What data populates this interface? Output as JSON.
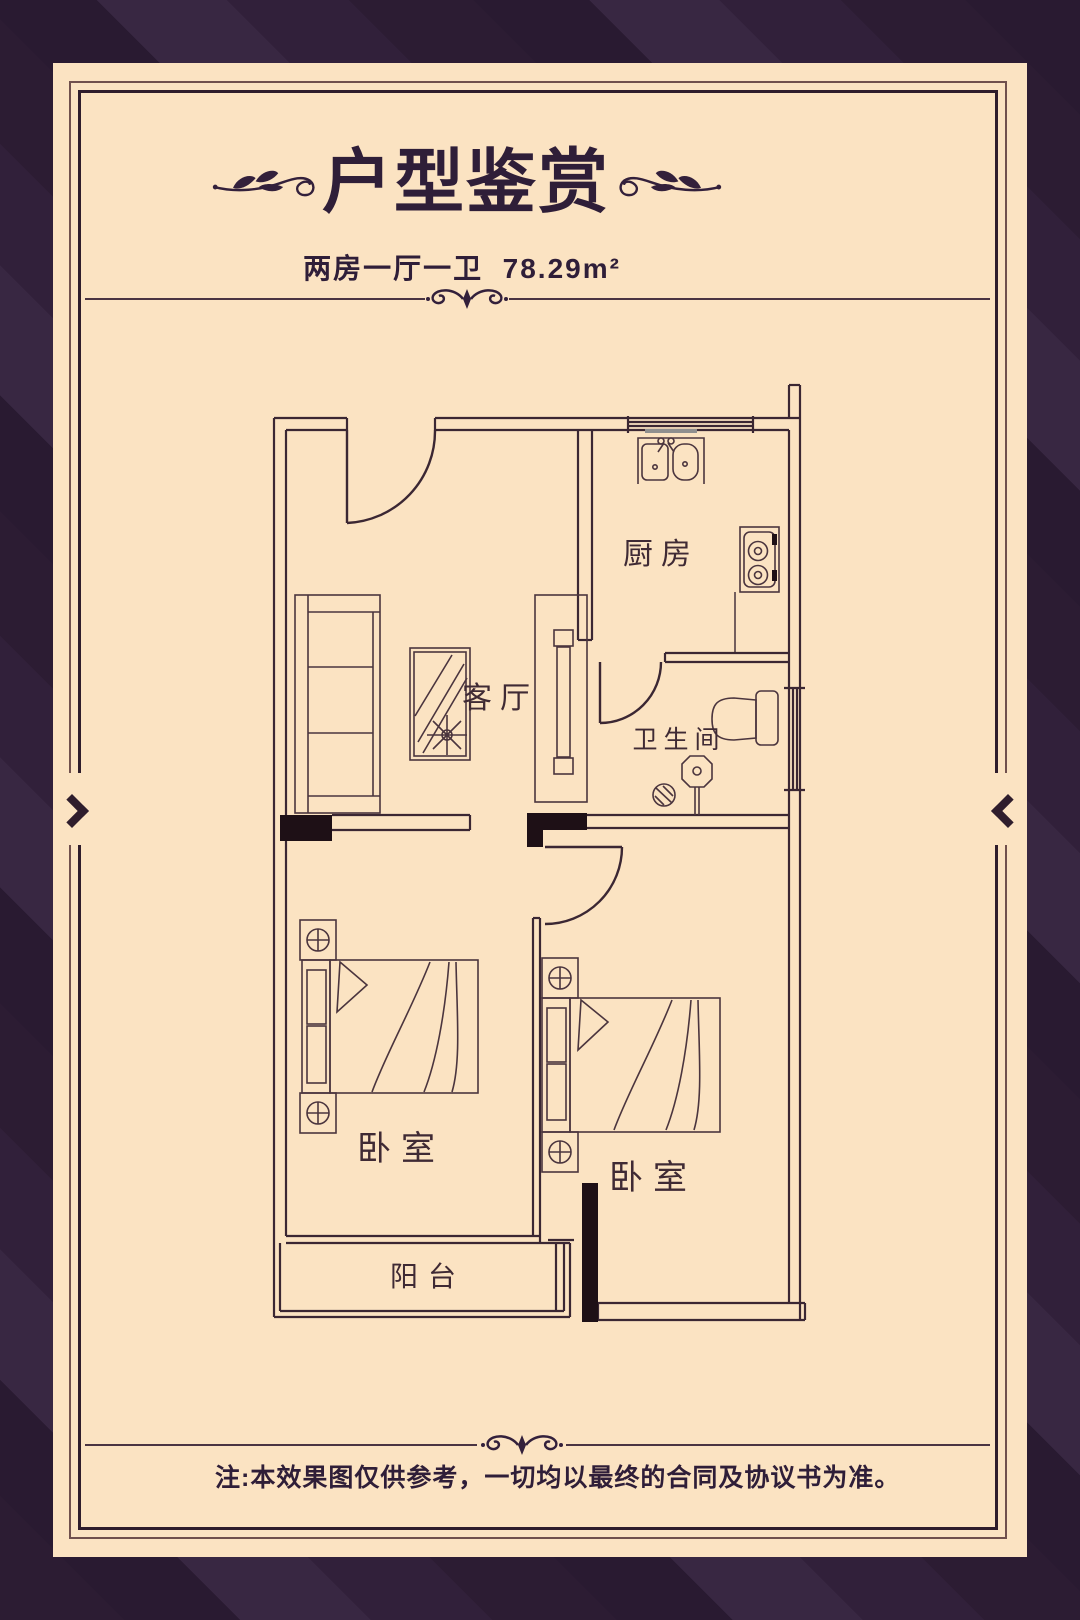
{
  "header": {
    "title": "户型鉴赏",
    "layout_text": "两房一厅一卫",
    "area_text": "78.29m²"
  },
  "floor_plan": {
    "rooms": [
      {
        "name": "kitchen",
        "label": "厨房"
      },
      {
        "name": "living-room",
        "label": "客厅"
      },
      {
        "name": "bathroom",
        "label": "卫生间"
      },
      {
        "name": "bedroom-1",
        "label": "卧室"
      },
      {
        "name": "bedroom-2",
        "label": "卧室"
      },
      {
        "name": "balcony",
        "label": "阳台"
      }
    ]
  },
  "footer": {
    "note": "注:本效果图仅供参考，一切均以最终的合同及协议书为准。"
  },
  "colors": {
    "stripe_dark": "#291a31",
    "stripe_light": "#382742",
    "card_background": "#fbe3c2",
    "ink": "#2f1e38",
    "wall_line": "#3b2733"
  }
}
